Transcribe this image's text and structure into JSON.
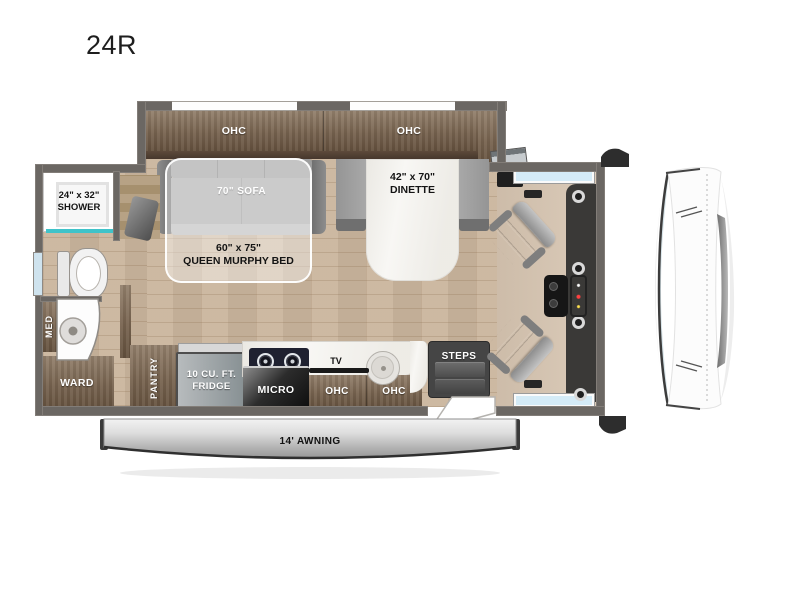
{
  "title": "24R",
  "colors": {
    "wall": "#6b6763",
    "floor_wood": "#cab59d",
    "cabinet_wood": "#77634f",
    "accent_teal": "#3fc3c9",
    "sofa_gray": "#a9a9a9",
    "cab_window_blue": "#d4ebf7",
    "awning_gray": "#c9c9c9",
    "dash_dark": "#3a3937",
    "console_screen_blue": "#1d8fdc"
  },
  "labels": {
    "ohc_slide_left": "OHC",
    "ohc_slide_right": "OHC",
    "sofa": "70\" SOFA",
    "dinette": [
      "42\" x 70\"",
      "DINETTE"
    ],
    "murphy_bed": [
      "60\" x 75\"",
      "QUEEN MURPHY BED"
    ],
    "shower": [
      "24\" x 32\"",
      "SHOWER"
    ],
    "med": "MED",
    "ward": "WARD",
    "pantry": "PANTRY",
    "fridge": [
      "10 CU. FT.",
      "FRIDGE"
    ],
    "micro": "MICRO",
    "tv": "TV",
    "ohc_kitchen_left": "OHC",
    "ohc_kitchen_right": "OHC",
    "steps": "STEPS",
    "awning": "14' AWNING"
  }
}
